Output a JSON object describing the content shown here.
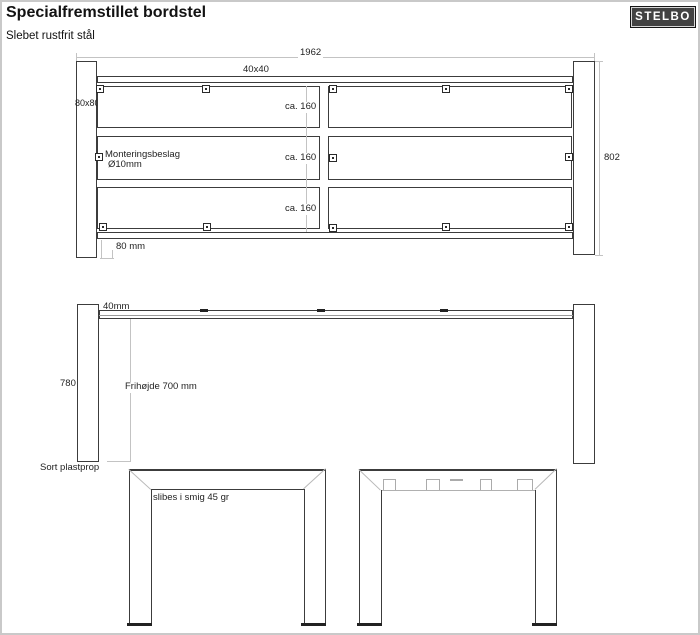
{
  "header": {
    "title": "Specialfremstillet bordstel",
    "subtitle": "Slebet rustfrit stål",
    "logo": "STELBO"
  },
  "top_view": {
    "dim_width": "1962",
    "dim_tube": "40x40",
    "dim_leg": "80x80",
    "dim_depth": "802",
    "dim_offset": "80 mm",
    "spacing_labels": [
      "ca. 160",
      "ca. 160",
      "ca. 160"
    ],
    "bracket_note_line1": "Monteringsbeslag",
    "bracket_note_line2": "Ø10mm"
  },
  "side_view": {
    "dim_tube": "40mm",
    "dim_leg_height": "780",
    "clearance_note": "Frihøjde 700 mm",
    "foot_note": "Sort plastprop"
  },
  "end_view": {
    "miter_note": "slibes i smig 45 gr"
  },
  "colors": {
    "linework": "#3c3c3c",
    "dimension_lines": "#c3c3c3",
    "logo_background": "#424242",
    "logo_text": "#ffffff",
    "background": "#ffffff"
  }
}
